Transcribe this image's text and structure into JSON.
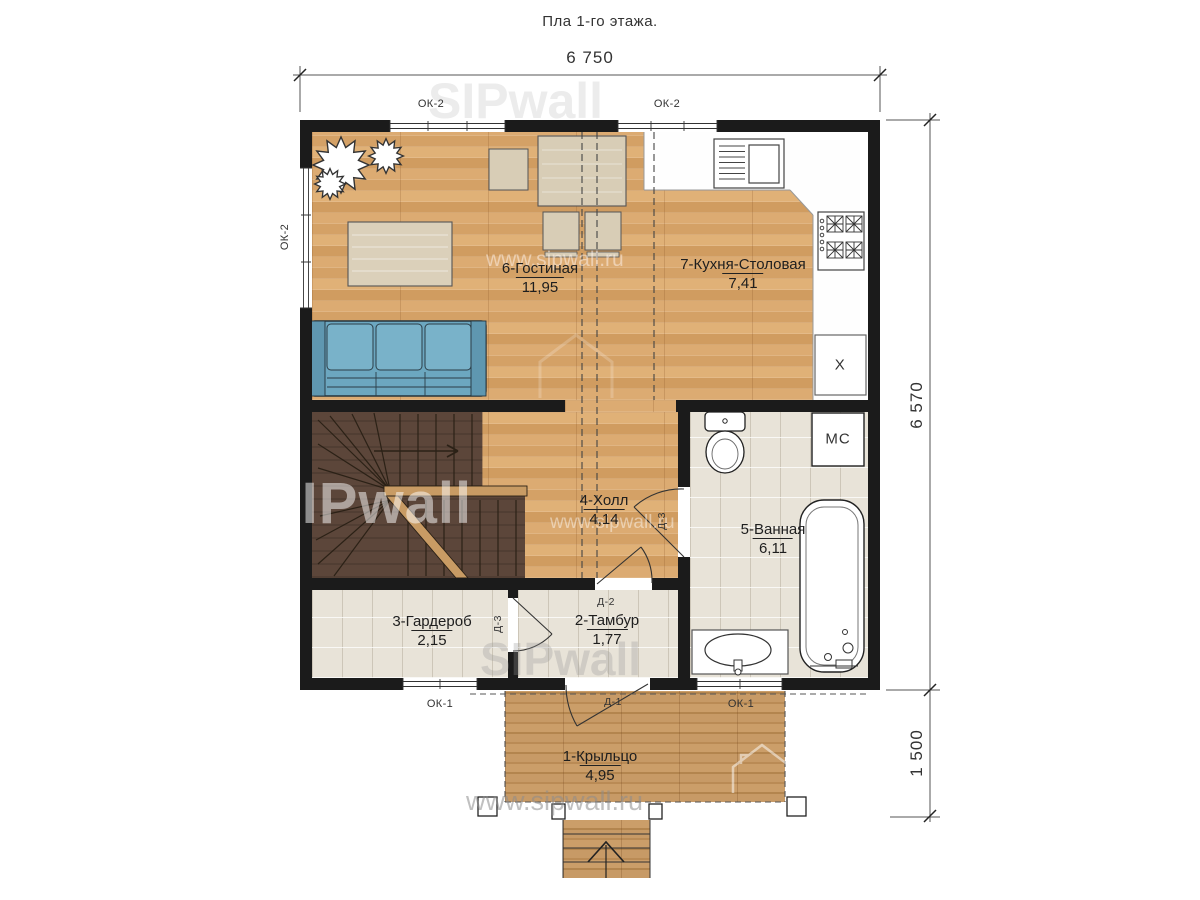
{
  "title": "Пла 1-го этажа.",
  "dimensions": {
    "width_top": "6 750",
    "height_right": "6 570",
    "porch_right": "1 500"
  },
  "rooms": [
    {
      "name": "6-Гостиная",
      "area": "11,95"
    },
    {
      "name": "7-Кухня-Столовая",
      "area": "7,41"
    },
    {
      "name": "4-Холл",
      "area": "4,14"
    },
    {
      "name": "5-Ванная",
      "area": "6,11"
    },
    {
      "name": "3-Гардероб",
      "area": "2,15"
    },
    {
      "name": "2-Тамбур",
      "area": "1,77"
    },
    {
      "name": "1-Крыльцо",
      "area": "4,95"
    }
  ],
  "windows": {
    "top_left": "ОК-2",
    "top_right": "ОК-2",
    "left": "ОК-2",
    "bottom_left": "ОК-1",
    "bottom_porch": "ОК-1"
  },
  "doors": {
    "entry": "Д-1",
    "vestibule": "Д-2",
    "wardrobe": "Д-3",
    "bathroom": "Д-3"
  },
  "appliances": {
    "washing_machine": "МС",
    "refrigerator": "Х"
  },
  "watermark": {
    "brand": "SIPwall",
    "site": "www.sipwall.ru"
  },
  "colors": {
    "walls": "#1b1b1b",
    "wood_floor": "#d9a76c",
    "porch_wood": "#c2945f",
    "stairs": "#5c463a",
    "tile": "#e8e3d8",
    "sofa": "#6ca7c0",
    "furniture": "#d8cdb6"
  }
}
